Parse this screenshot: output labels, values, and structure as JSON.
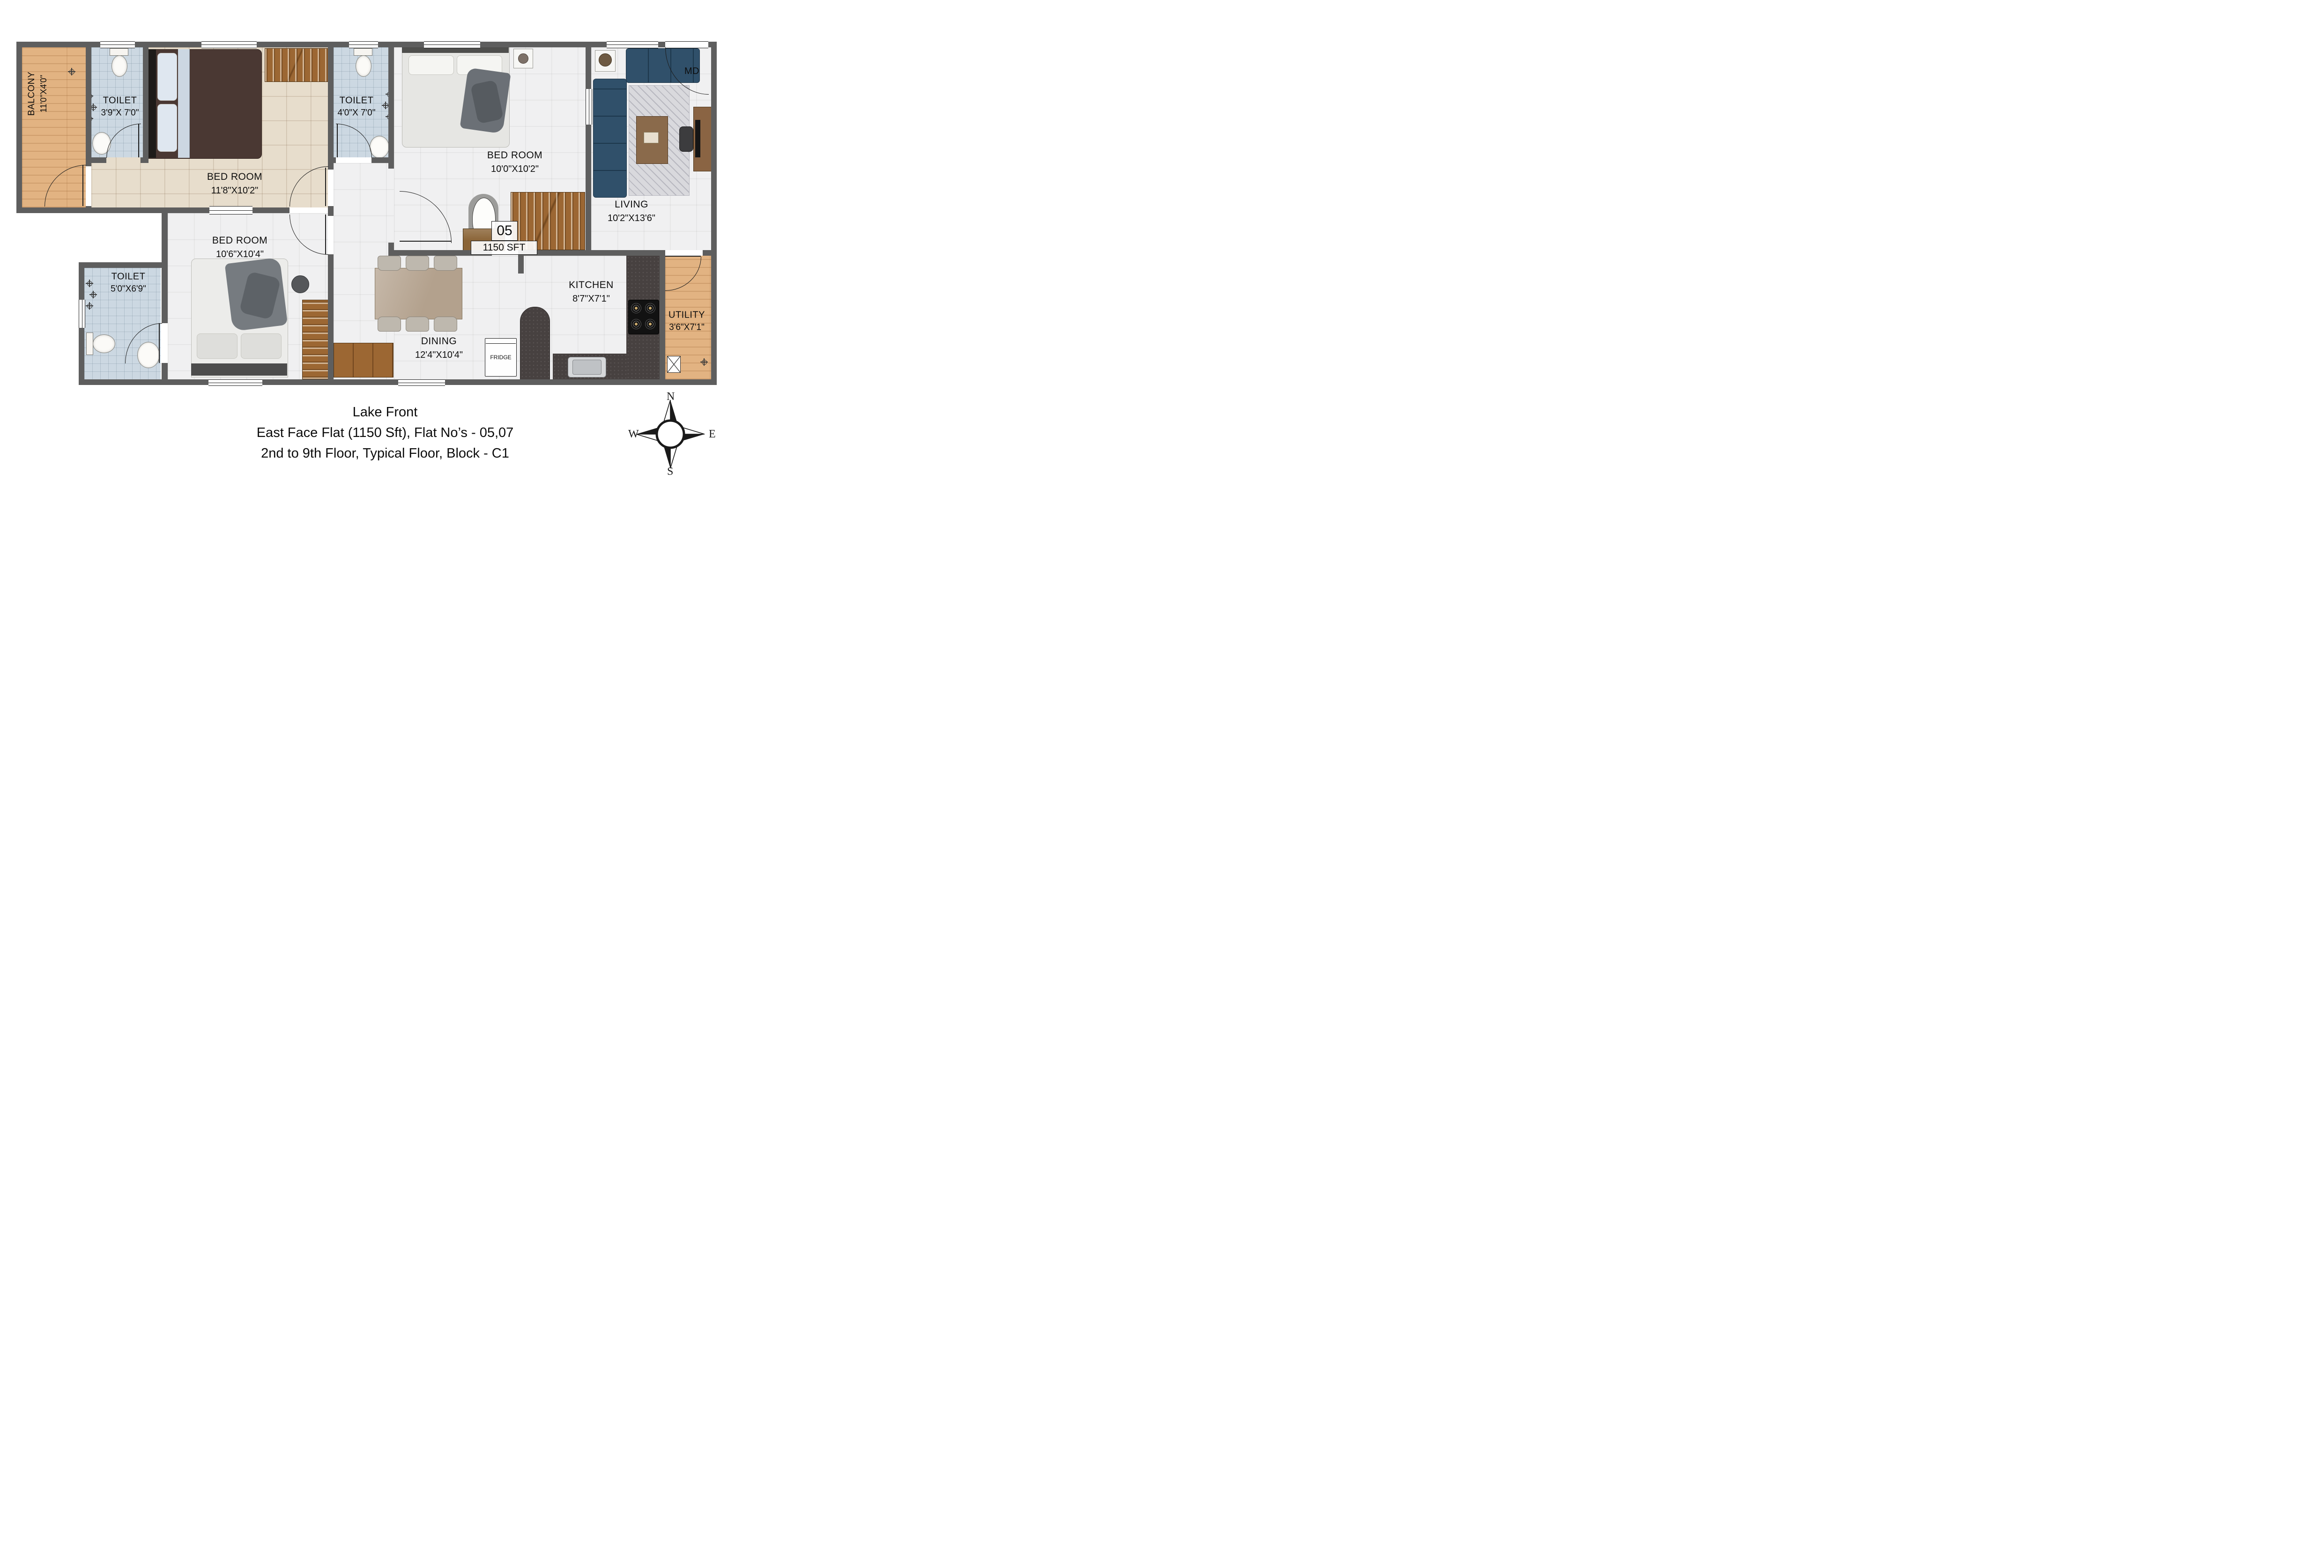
{
  "title": {
    "line1": "Lake Front",
    "line2": "East Face Flat (1150 Sft), Flat No’s - 05,07",
    "line3": "2nd to 9th Floor, Typical Floor, Block - C1"
  },
  "flat": {
    "number": "05",
    "area": "1150 SFT"
  },
  "rooms": {
    "balcony": {
      "name": "BALCONY",
      "dims": "11'0\"X4'0\""
    },
    "toilet1": {
      "name": "TOILET",
      "dims": "3'9\"X 7'0\""
    },
    "bedroom1": {
      "name": "BED ROOM",
      "dims": "11'8\"X10'2\""
    },
    "toilet2": {
      "name": "TOILET",
      "dims": "4'0\"X 7'0\""
    },
    "bedroom2": {
      "name": "BED ROOM",
      "dims": "10'0\"X10'2\""
    },
    "living": {
      "name": "LIVING",
      "dims": "10'2\"X13'6\""
    },
    "bedroom3": {
      "name": "BED ROOM",
      "dims": "10'6\"X10'4\""
    },
    "toilet3": {
      "name": "TOILET",
      "dims": "5'0\"X6'9\""
    },
    "dining": {
      "name": "DINING",
      "dims": "12'4\"X10'4\""
    },
    "kitchen": {
      "name": "KITCHEN",
      "dims": "8'7\"X7'1\""
    },
    "utility": {
      "name": "UTILITY",
      "dims": "3'6\"X7'1\""
    }
  },
  "labels": {
    "main_door": "MD",
    "fridge": "FRIDGE"
  },
  "compass": {
    "north": "N",
    "east": "E",
    "south": "S",
    "west": "W"
  },
  "colors": {
    "wall": "#5e5e5e",
    "wood": "#e2b382",
    "toilet_floor": "#ccd8e2",
    "bedroom1_floor": "#e7ddcc",
    "tile": "#f0f0f1",
    "granite": "#474140",
    "wardrobe": "#9c6733",
    "sofa": "#30506a"
  }
}
